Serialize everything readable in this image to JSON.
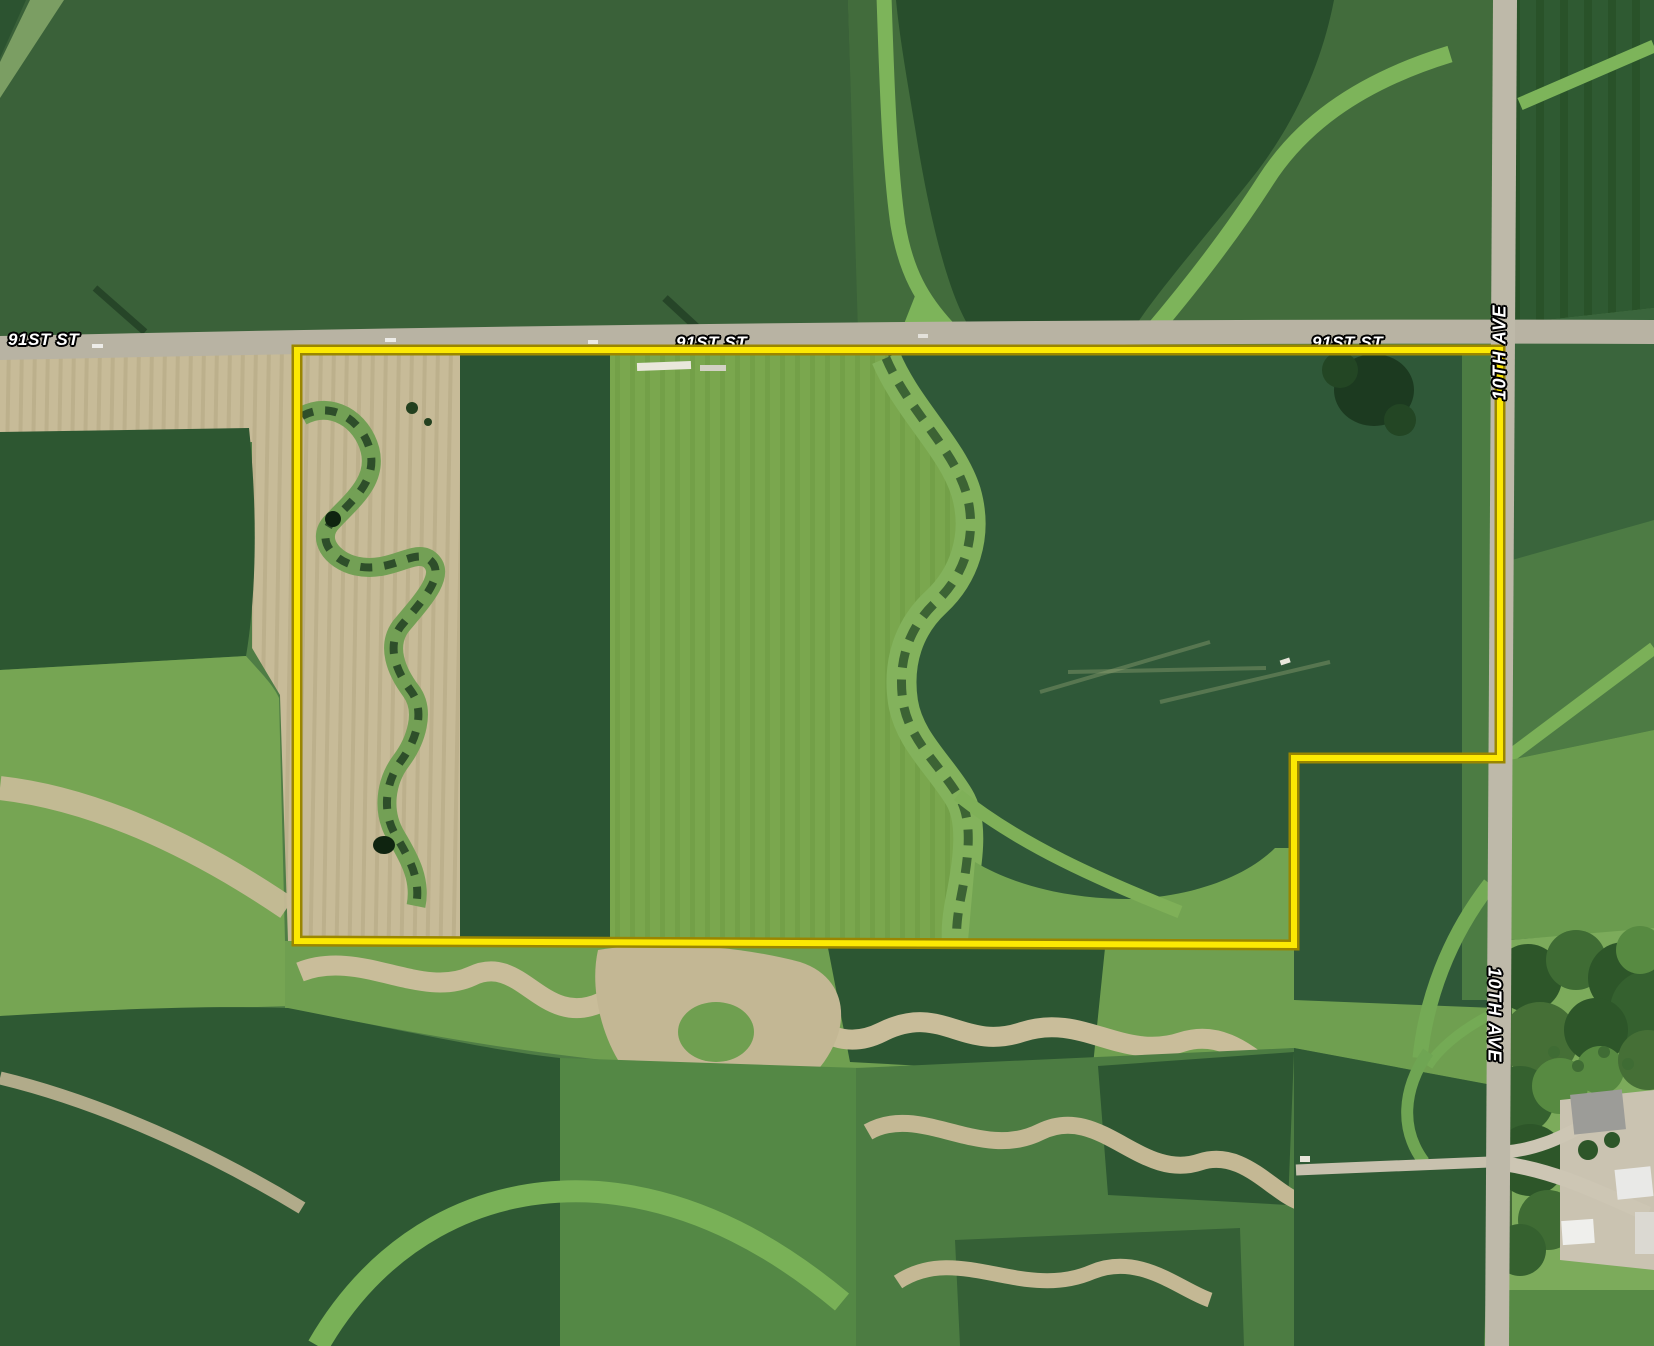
{
  "map": {
    "description": "aerial-plat-map",
    "road_labels": {
      "horizontal": [
        {
          "text": "91ST ST",
          "position": "west"
        },
        {
          "text": "91ST ST",
          "position": "center"
        },
        {
          "text": "91ST ST",
          "position": "east"
        }
      ],
      "vertical": [
        {
          "text": "10TH AVE",
          "position": "north",
          "rotation": -90
        },
        {
          "text": "10TH AVE",
          "position": "south",
          "rotation": 90
        }
      ]
    },
    "boundary": {
      "points": "297,350 1500,350 1500,758 1294,758 1294,945 297,941",
      "color": "#fce903",
      "outline_color": "#9a8600"
    },
    "colors": {
      "label_text": "#ffffff",
      "label_outline": "#000000",
      "road_surface": "#b8b3a3",
      "dark_crop_field": "#294f2d",
      "tilled_field_tan": "#c7bb98",
      "pasture_green": "#76a553"
    }
  }
}
